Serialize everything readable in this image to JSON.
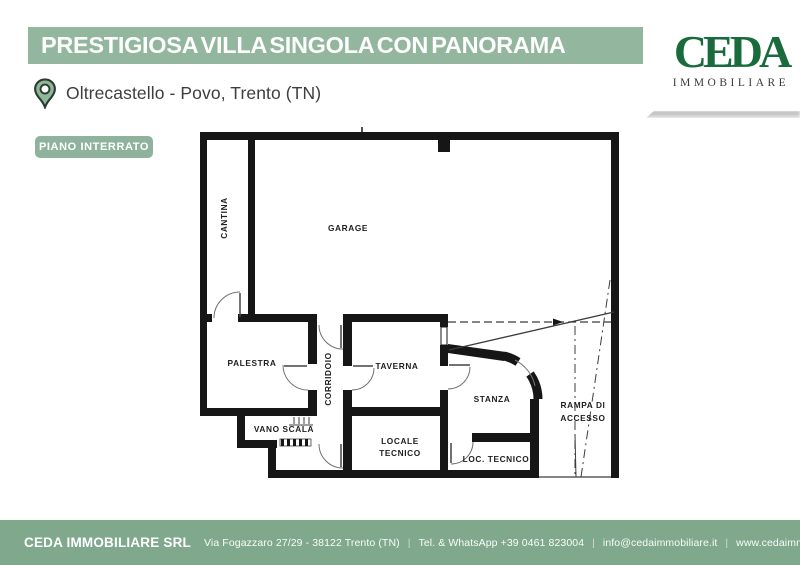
{
  "header": {
    "title": "PRESTIGIOSA VILLA SINGOLA CON PANORAMA",
    "location": "Oltrecastello - Povo, Trento (TN)",
    "floor_label": "PIANO INTERRATO"
  },
  "logo": {
    "brand": "CEDA",
    "tagline": "IMMOBILIARE"
  },
  "floorplan": {
    "rooms": {
      "cantina": "CANTINA",
      "garage": "GARAGE",
      "palestra": "PALESTRA",
      "corridoio": "CORRIDOIO",
      "taverna": "TAVERNA",
      "stanza": "STANZA",
      "vano_scala": "VANO SCALA",
      "locale_tecnico_l1": "LOCALE",
      "locale_tecnico_l2": "TECNICO",
      "loc_tecnico": "LOC. TECNICO",
      "rampa_l1": "RAMPA DI",
      "rampa_l2": "ACCESSO"
    }
  },
  "footer": {
    "company": "CEDA IMMOBILIARE SRL",
    "address": "Via Fogazzaro 27/29 - 38122 Trento (TN)",
    "phone": "Tel. & WhatsApp +39 0461 823004",
    "email": "info@cedaimmobiliare.it",
    "website": "www.cedaimmobiliare.it",
    "separator": "|"
  },
  "colors": {
    "banner_green": "#93b69f",
    "badge_green": "#8eb29b",
    "footer_green": "#7fa88c",
    "logo_green": "#1a6b3c",
    "pin_green": "#8cb897",
    "wall_black": "#161616"
  }
}
